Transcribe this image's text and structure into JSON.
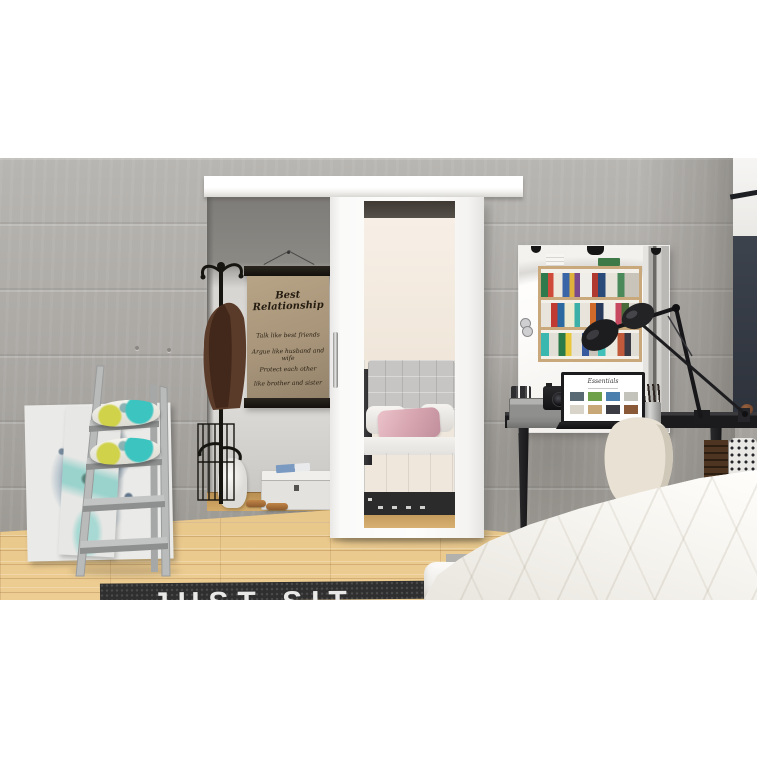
{
  "scene": {
    "type": "interior-product-photo",
    "subject": "White sliding door with mirror panel in a bedroom with gray concrete walls",
    "poster": {
      "title": "Best Relationship",
      "lines": [
        "Talk like best friends",
        "Argue like husband and wife",
        "Protect each other",
        "like brother and sister"
      ]
    },
    "rug_text": "JUST SIT",
    "laptop_screen_title": "Essentials",
    "palette": {
      "wall_concrete": "#aaa8a4",
      "accent_dark_wall": "#353b44",
      "door_white": "#fbfbfa",
      "floor_wood": "#dcb87a",
      "rug_dark": "#2f2f2f",
      "desk_black": "#1b1b1d",
      "pillow_teal": "#3cc4c0",
      "pillow_yellow": "#d0d24a",
      "crate_wood": "#a97a4a",
      "poster_paper": "#ab9778",
      "coat_brown": "#5a3a28",
      "bed_white": "#f8f6f1"
    }
  }
}
